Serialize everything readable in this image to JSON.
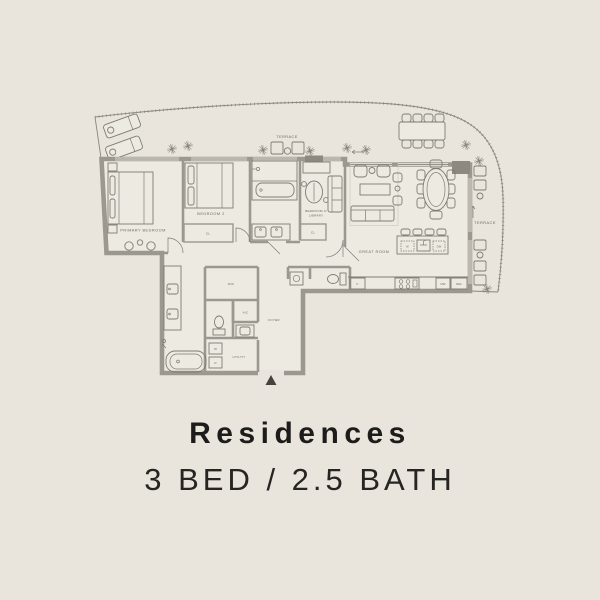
{
  "title": "Residences",
  "subtitle": "3 BED / 2.5 BATH",
  "labels": {
    "terrace_top": "TERRACE",
    "terrace_right": "TERRACE",
    "primary_bedroom": "PRIMARY BEDROOM",
    "bedroom_2": "BEDROOM 2",
    "bedroom_3_line1": "BEDROOM 3/",
    "bedroom_3_line2": "LIBRARY",
    "great_room": "GREAT ROOM",
    "wic": "WIC",
    "ac": "A/C",
    "utility": "UTILITY",
    "foyer": "FOYER",
    "closet_bed2": "CL",
    "closet_bed3": "CL",
    "washer": "W",
    "dryer": "D",
    "pantry": "P",
    "island_left": "W",
    "island_right": "DW",
    "microwave": "MW",
    "refrigerator": "REF"
  },
  "colors": {
    "background": "#e9e5dd",
    "interior": "#edeae2",
    "wall": "#9c988f",
    "walldark": "#8d8980",
    "line": "#7f7c74",
    "text": "#6d6a62",
    "title_text": "#1d1c1a"
  }
}
